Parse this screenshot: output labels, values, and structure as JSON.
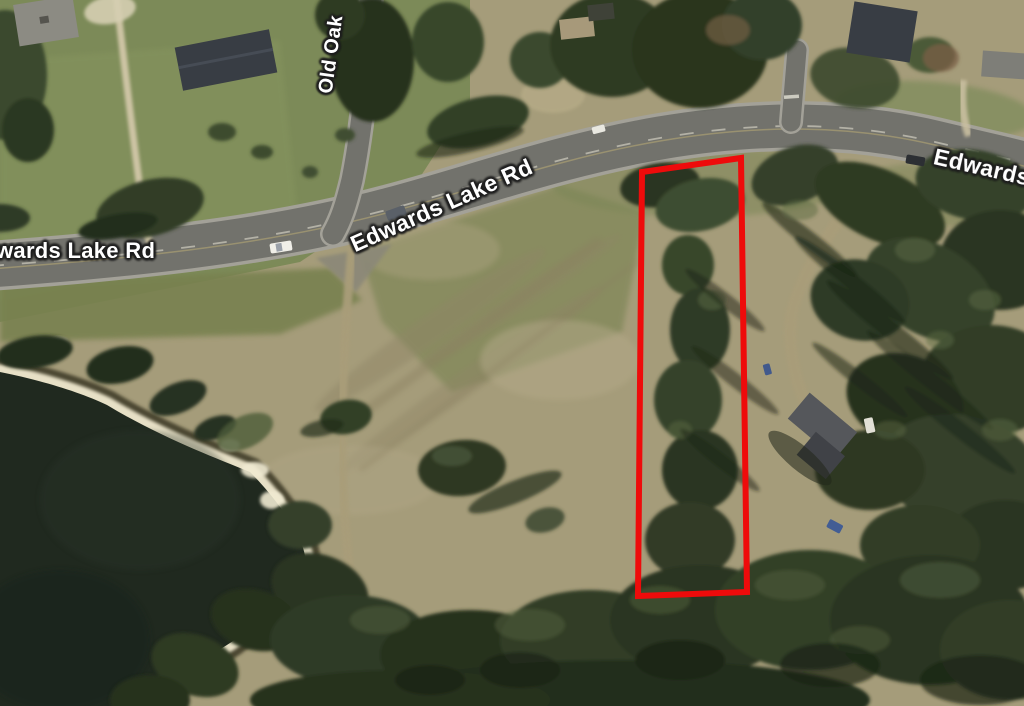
{
  "labels": {
    "main_road_center": "Edwards Lake Rd",
    "main_road_left_clipped": "wards Lake Rd",
    "main_road_right_clipped": "Edwards",
    "side_road": "Old Oak"
  },
  "overlay": {
    "parcel_points": "642,172 741,158 747,592 638,596"
  },
  "colors": {
    "parcel_red": "#ee0b0b",
    "water": "#20291f",
    "field_tan": "#a59c7a",
    "lawn_green": "#7c8a58",
    "olive_green": "#78814f",
    "forest_dark": "#2c3722",
    "forest_mid": "#3c4a2c",
    "forest_light": "#566741",
    "road_asphalt": "#72726c",
    "road_edge": "#a3a198",
    "sand": "#e7e0c6",
    "dirt_path": "#a99d79",
    "driveway_light": "#cdc4a4",
    "house_dark_roof": "#383d44",
    "house_gray_roof": "#8c8b83",
    "label_text": "#ffffff",
    "label_outline": "#1e1e1e"
  }
}
